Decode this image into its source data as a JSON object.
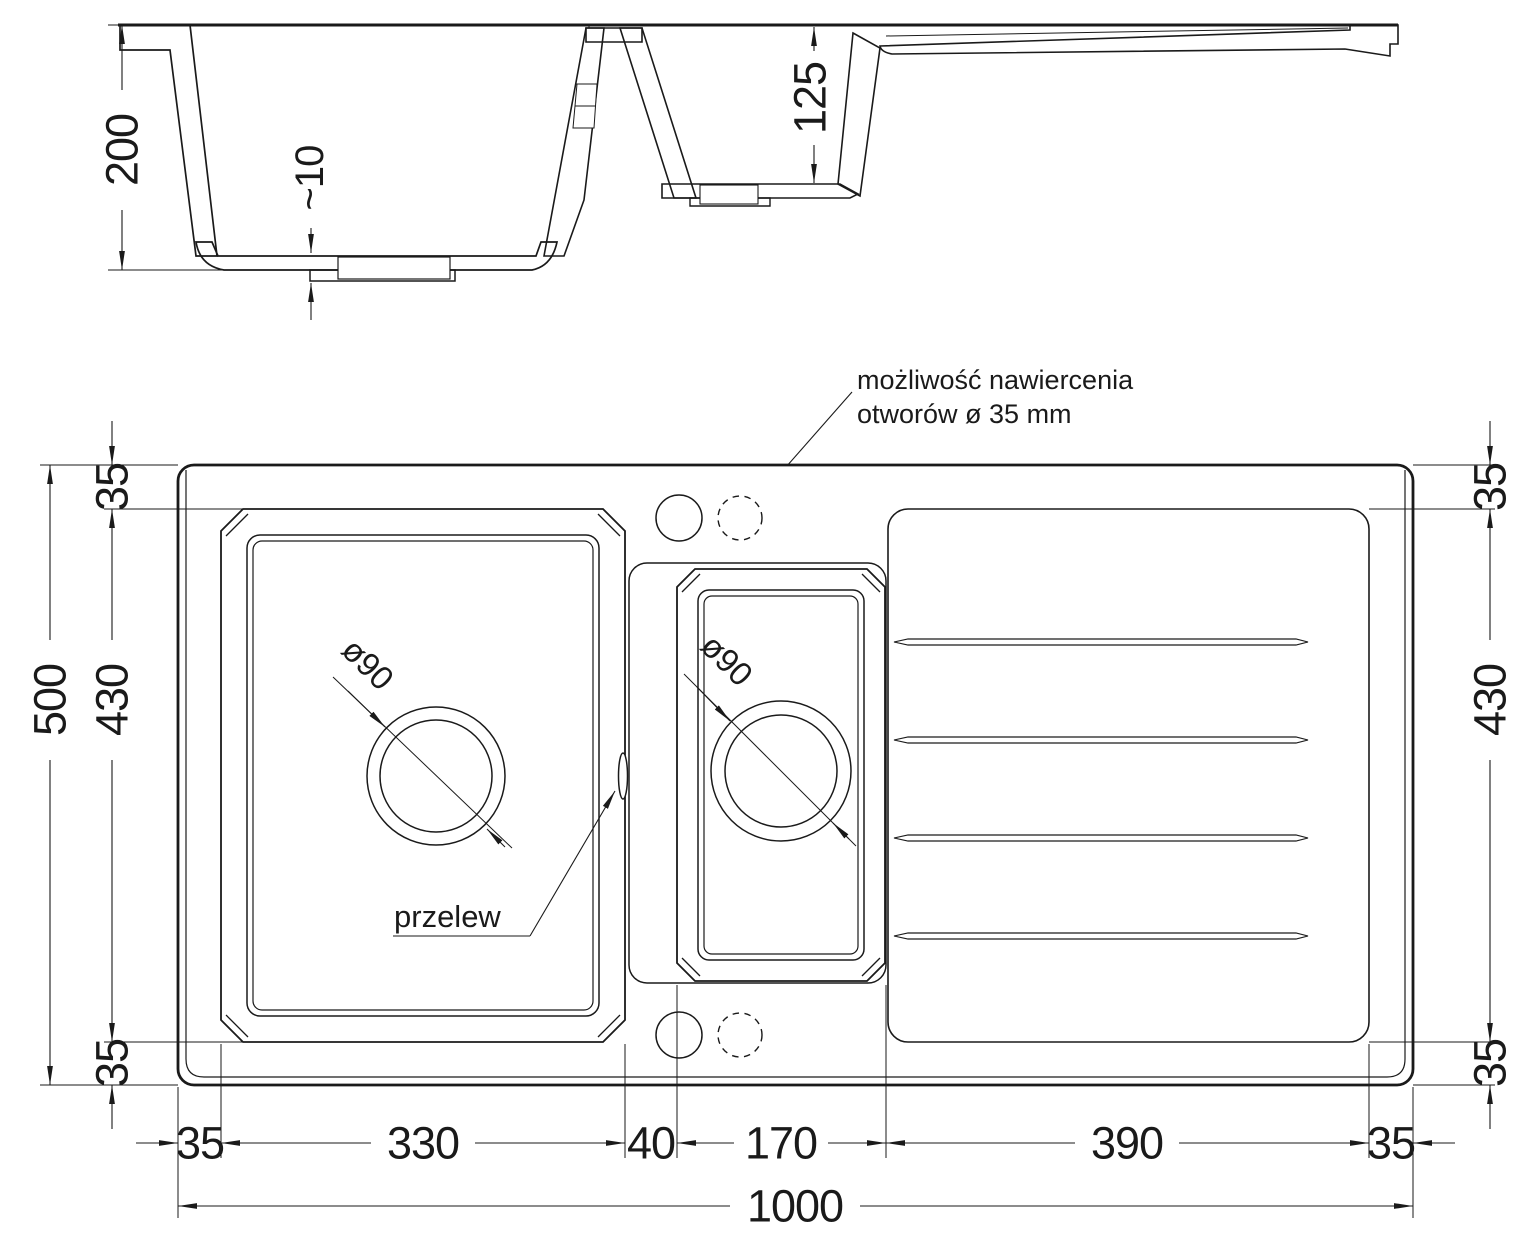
{
  "drawing": {
    "annotation": {
      "line1": "możliwość nawiercenia",
      "line2": "otworów ø 35 mm"
    },
    "section": {
      "overall_depth": "200",
      "bottom_thickness": "~10",
      "small_bowl_depth": "125"
    },
    "plan": {
      "main_drain": "ø90",
      "small_drain": "ø90",
      "overflow": "przelew"
    },
    "dims_left": {
      "overall_height": "500",
      "inner_height": "430",
      "top_margin": "35",
      "bottom_margin": "35"
    },
    "dims_right": {
      "top_margin": "35",
      "inner_height": "430",
      "bottom_margin": "35"
    },
    "dims_bottom": {
      "left_margin": "35",
      "main_bowl_width": "330",
      "divider_width": "40",
      "small_bowl_width": "170",
      "drainer_width": "390",
      "right_margin": "35",
      "overall_width": "1000"
    },
    "colors": {
      "ink": "#1a1a1a",
      "background": "#ffffff"
    }
  }
}
